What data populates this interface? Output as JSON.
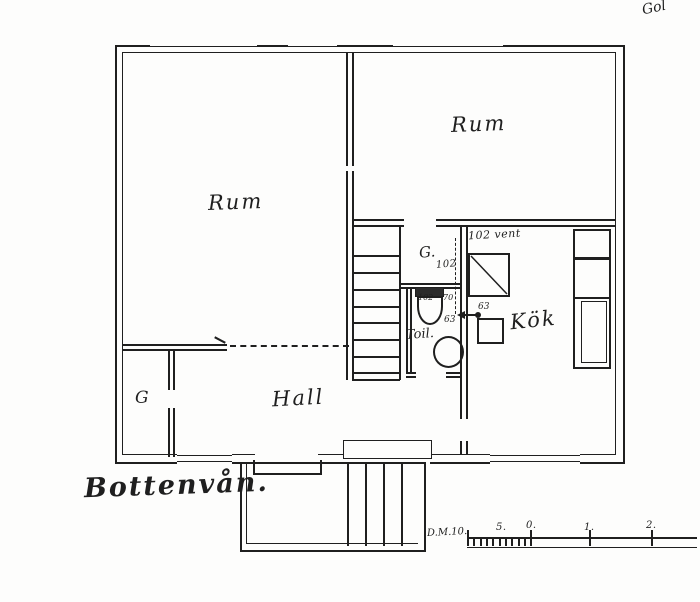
{
  "drawing": {
    "title": "Bottenvån.",
    "corner_note": "Gol",
    "rooms": {
      "room_left": "Rum",
      "room_right": "Rum",
      "hall": "Hall",
      "kitchen": "Kök",
      "toilet": "Toil.",
      "closet_hall": "G",
      "closet_upper": "G."
    },
    "annotations": {
      "vent_label": "102 vent",
      "closet_duct": "102",
      "wc_width": "102",
      "wc_depth": "70",
      "basin_size": "63",
      "sink_size": "63"
    },
    "scale_bar": {
      "label": "D.M.10.",
      "tick_labels": [
        "5.",
        "0.",
        "1.",
        "2."
      ]
    },
    "colors": {
      "ink": "#1f1f1f",
      "paper": "#fdfdfc"
    }
  }
}
